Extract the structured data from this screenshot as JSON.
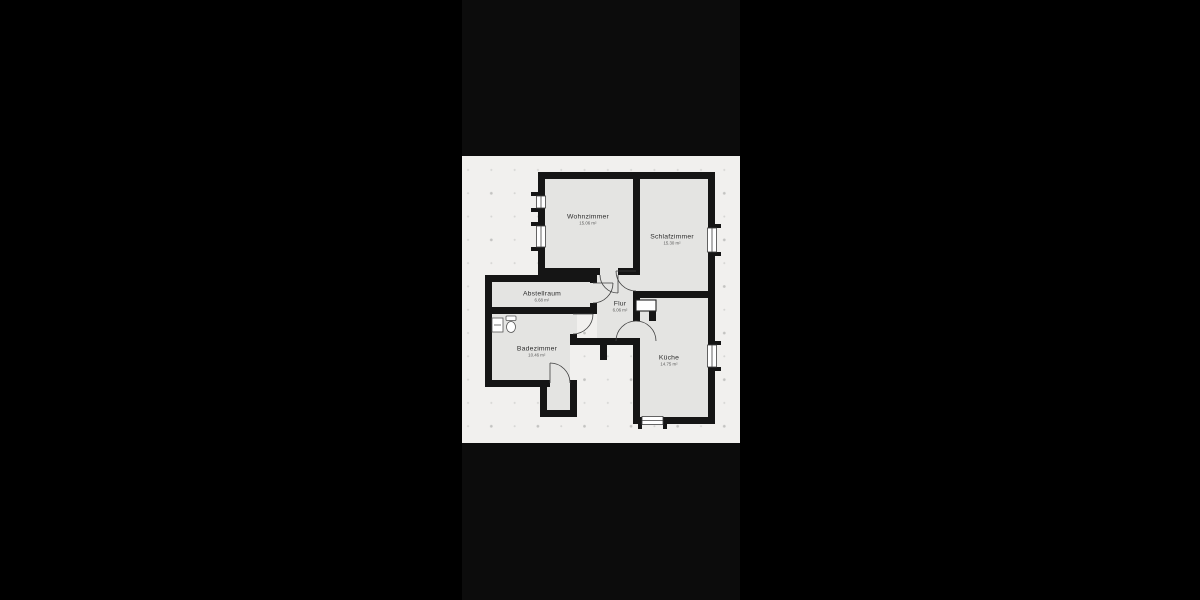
{
  "colors": {
    "page_background": "#000000",
    "letterbox_bar": "#0c0c0c",
    "plan_background": "#f1f0ee",
    "wall": "#151515",
    "room_fill": "#e4e4e2",
    "label_text": "#2e2e2e",
    "area_text": "#5a5a5a"
  },
  "rooms": {
    "wohnzimmer": {
      "label": "Wohnzimmer",
      "area": "15.06 m²"
    },
    "schlafzimmer": {
      "label": "Schlafzimmer",
      "area": "15.30 m²"
    },
    "abstellraum": {
      "label": "Abstellraum",
      "area": "6.68 m²"
    },
    "flur": {
      "label": "Flur",
      "area": "6.06 m²"
    },
    "badezimmer": {
      "label": "Badezimmer",
      "area": "10.46 m²"
    },
    "kueche": {
      "label": "Küche",
      "area": "14.75 m²"
    }
  }
}
